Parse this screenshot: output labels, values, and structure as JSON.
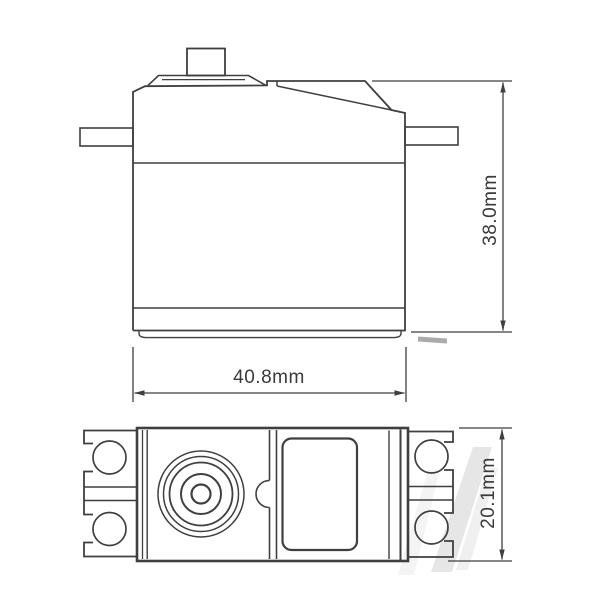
{
  "dimensions": {
    "height_label": "38.0mm",
    "width_label": "40.8mm",
    "depth_label": "20.1mm"
  },
  "colors": {
    "line": "#3f3f3f",
    "text": "#3a3a3a",
    "background": "#ffffff",
    "watermark": "#e2e2e2"
  }
}
